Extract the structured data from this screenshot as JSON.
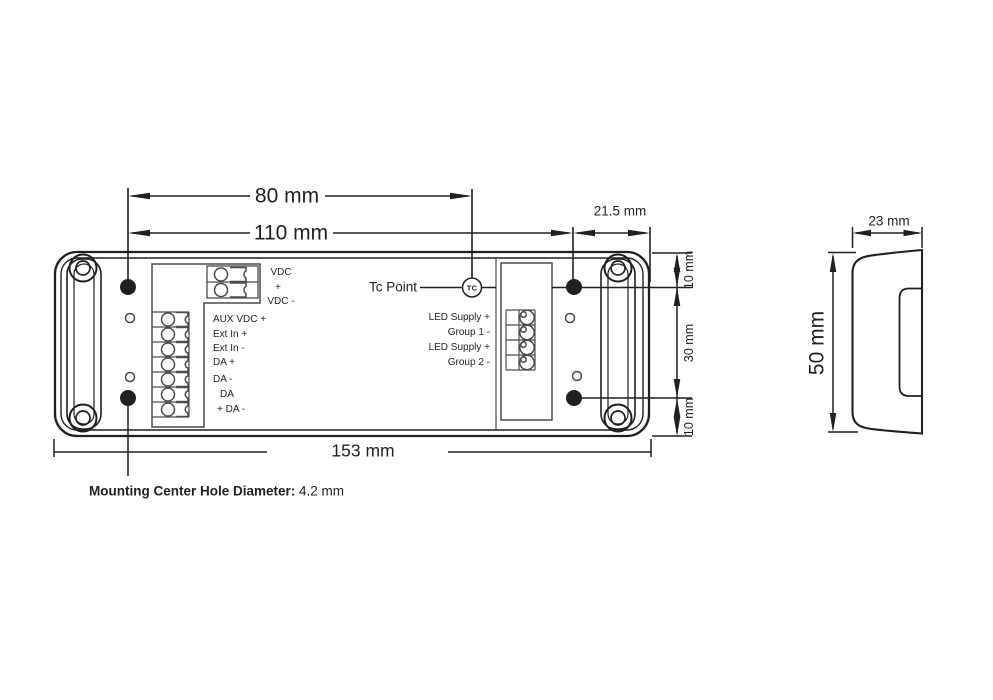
{
  "colors": {
    "line": "#231f20",
    "secondary": "#4d4a4b",
    "background": "#ffffff"
  },
  "diagram": {
    "dims": {
      "d80": "80 mm",
      "d110": "110 mm",
      "d21_5": "21.5 mm",
      "d153": "153 mm",
      "d10_top": "10 mm",
      "d30": "30 mm",
      "d10_bottom": "10 mm",
      "d23": "23 mm",
      "d50": "50 mm"
    },
    "tc": {
      "label": "Tc Point",
      "symbol": "TC"
    },
    "left_terminals": {
      "power": [
        "VDC",
        "+",
        "VDC -"
      ],
      "signals": [
        "AUX VDC +",
        "Ext In +",
        "Ext In -",
        "DA +",
        "DA -",
        "DA",
        "+ DA -"
      ]
    },
    "right_terminals": [
      "LED Supply +",
      "Group 1 -",
      "LED Supply +",
      "Group 2 -"
    ],
    "note": {
      "bold": "Mounting Center Hole Diameter:",
      "value": " 4.2 mm"
    }
  }
}
